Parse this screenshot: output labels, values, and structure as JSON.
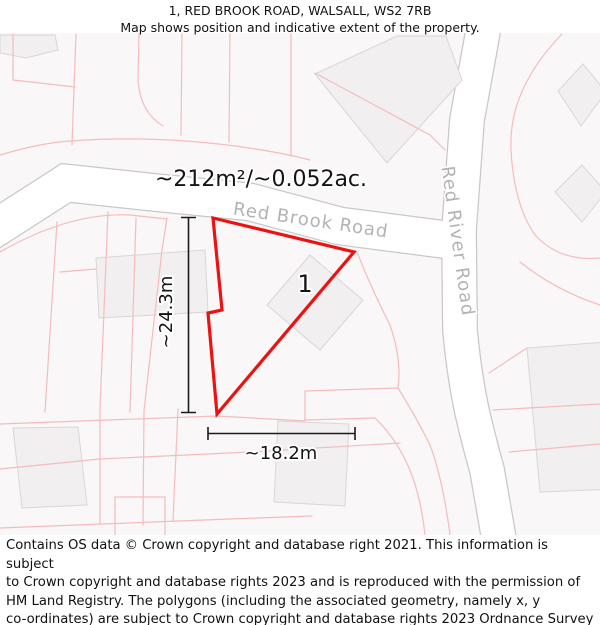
{
  "header": {
    "title": "1, RED BROOK ROAD, WALSALL, WS2 7RB",
    "subtitle": "Map shows position and indicative extent of the property."
  },
  "map": {
    "area_label": "~212m²/~0.052ac.",
    "plot_number": "1",
    "roads": [
      {
        "name": "Red Brook Road"
      },
      {
        "name": "Red River Road"
      }
    ],
    "dimensions": {
      "height": "~24.3m",
      "width": "~18.2m"
    }
  },
  "footer": {
    "lines": [
      "Contains OS data © Crown copyright and database right 2021. This information is subject",
      "to Crown copyright and database rights 2023 and is reproduced with the permission of",
      "HM Land Registry. The polygons (including the associated geometry, namely x, y",
      "co-ordinates) are subject to Crown copyright and database rights 2023 Ordnance Survey",
      "100026316."
    ]
  },
  "colors": {
    "property_outline": "#ed1212",
    "road_label": "#b4b2b2",
    "parcel_line": "#f5bcbc",
    "building_fill": "#f1efef",
    "building_stroke": "#d8d6d6",
    "road_edge": "#c9c7c7",
    "map_background": "#f9f7f7",
    "text": "#111111"
  }
}
